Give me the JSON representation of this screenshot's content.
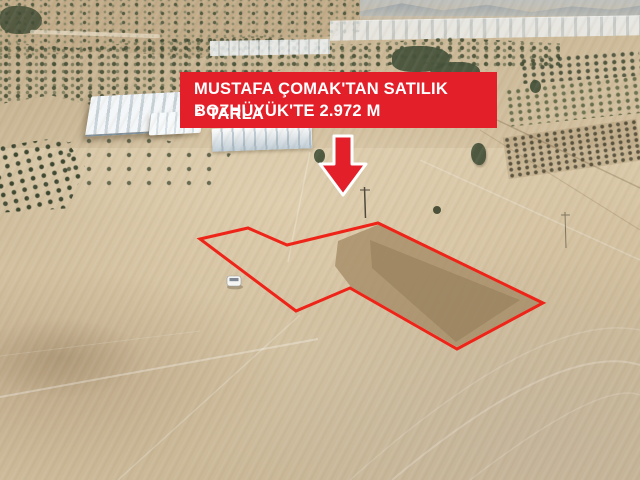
{
  "banner": {
    "line1": "MUSTAFA ÇOMAK'TAN SATILIK",
    "line2_prefix": "BOZHÜYÜK'TE 2.972 M",
    "line2_superscript": "2",
    "line2_suffix": "TARLA",
    "background_color": "#e3202a",
    "text_color": "#ffffff"
  },
  "annotations": {
    "arrow": {
      "type": "down-arrow",
      "fill_color": "#e3202a",
      "outline_color": "#ffffff"
    },
    "parcel_outline": {
      "color": "#ee2419",
      "points": "200,239 248,228 287,245 378,223 543,303 457,349 350,288 296,311"
    }
  },
  "scene": {
    "type": "aerial-drone-photo",
    "features": [
      "dry tan farmland fields with track lines",
      "scrub tree band and hills at top",
      "white warehouse and greenhouses",
      "orchard tree rows left and right",
      "marked land parcel outlined in red",
      "small white car near parcel",
      "utility poles"
    ]
  }
}
